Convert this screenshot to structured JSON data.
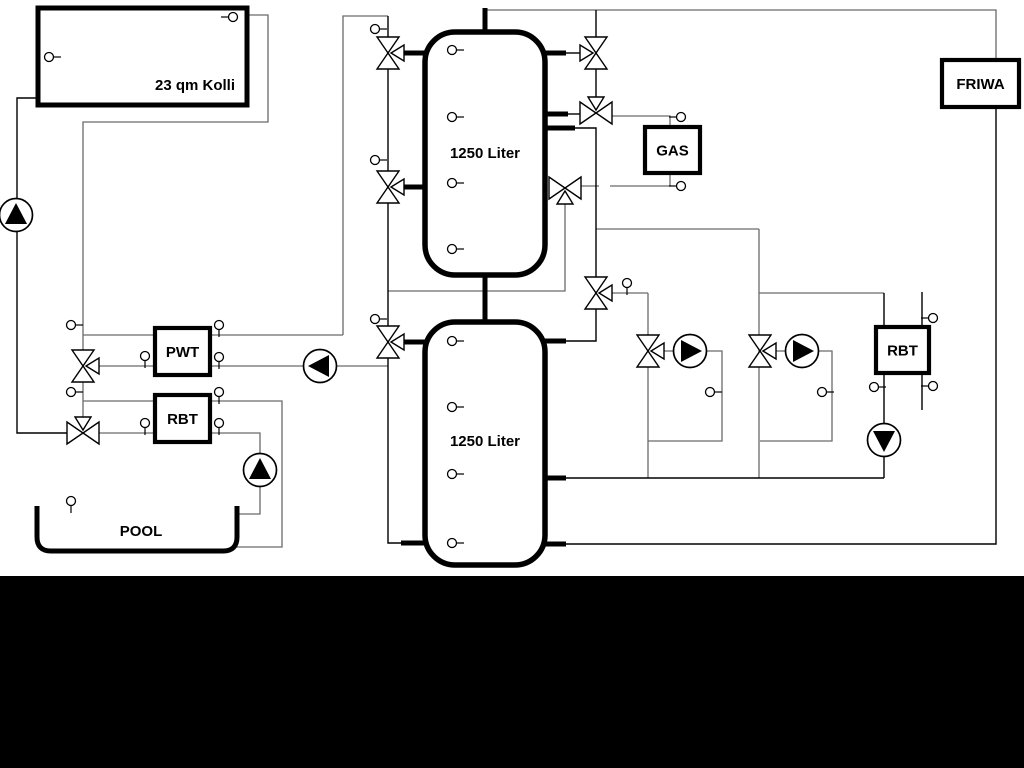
{
  "diagram": {
    "title": "Hydraulic schematic: solar collector, buffer tanks, gas boiler, pool",
    "background": "#ffffff",
    "bottom_bar": {
      "top": 576,
      "color": "#000000"
    },
    "colors": {
      "black": "#000000",
      "gray": "#6a6a6a",
      "fill": "#ffffff"
    },
    "labels": {
      "collector": "23 qm Kolli",
      "tank_top": "1250 Liter",
      "tank_bottom": "1250 Liter",
      "pwt": "PWT",
      "rbt_left": "RBT",
      "rbt_right": "RBT",
      "gas": "GAS",
      "friwa": "FRIWA",
      "pool": "POOL"
    },
    "collector": {
      "x": 38,
      "y": 8,
      "w": 209,
      "h": 97,
      "label": "collector",
      "label_x": 195,
      "label_y": 90
    },
    "tanks": [
      {
        "x": 425,
        "y": 32,
        "w": 120,
        "h": 243,
        "r": 30,
        "label": "tank_top",
        "name": "buffer-tank-1",
        "label_y": 158
      },
      {
        "x": 425,
        "y": 322,
        "w": 120,
        "h": 243,
        "r": 30,
        "label": "tank_bottom",
        "name": "buffer-tank-2",
        "label_y": 446
      }
    ],
    "boxes": [
      {
        "x": 155,
        "y": 328,
        "w": 55,
        "h": 47,
        "label": "pwt",
        "name": "pwt-heat-exchanger"
      },
      {
        "x": 155,
        "y": 395,
        "w": 55,
        "h": 47,
        "label": "rbt_left",
        "name": "rbt-left-heat-exchanger"
      },
      {
        "x": 645,
        "y": 127,
        "w": 55,
        "h": 46,
        "label": "gas",
        "name": "gas-boiler"
      },
      {
        "x": 942,
        "y": 60,
        "w": 77,
        "h": 47,
        "label": "friwa",
        "name": "friwa-station"
      },
      {
        "x": 876,
        "y": 327,
        "w": 53,
        "h": 46,
        "label": "rbt_right",
        "name": "rbt-right-heat-exchanger"
      }
    ],
    "pool": {
      "x1": 37,
      "x2": 237,
      "top": 506,
      "bottom": 551,
      "r": 14,
      "label": "pool",
      "label_x": 141,
      "label_y": 536
    },
    "lines": [
      {
        "c": "gray",
        "pts": [
          [
            247,
            15
          ],
          [
            268,
            15
          ],
          [
            268,
            122
          ],
          [
            83,
            122
          ],
          [
            83,
            419
          ]
        ]
      },
      {
        "c": "gray",
        "pts": [
          [
            83,
            335
          ],
          [
            155,
            335
          ]
        ]
      },
      {
        "c": "gray",
        "pts": [
          [
            210,
            335
          ],
          [
            343,
            335
          ]
        ]
      },
      {
        "c": "gray",
        "pts": [
          [
            343,
            335
          ],
          [
            343,
            16
          ],
          [
            388,
            16
          ]
        ]
      },
      {
        "c": "gray",
        "pts": [
          [
            97,
            366
          ],
          [
            155,
            366
          ]
        ]
      },
      {
        "c": "gray",
        "pts": [
          [
            210,
            366
          ],
          [
            388,
            366
          ]
        ]
      },
      {
        "c": "gray",
        "pts": [
          [
            83,
            401
          ],
          [
            155,
            401
          ]
        ]
      },
      {
        "c": "gray",
        "pts": [
          [
            210,
            401
          ],
          [
            282,
            401
          ],
          [
            282,
            547
          ],
          [
            237,
            547
          ]
        ]
      },
      {
        "c": "gray",
        "pts": [
          [
            99,
            433
          ],
          [
            155,
            433
          ]
        ]
      },
      {
        "c": "gray",
        "pts": [
          [
            210,
            433
          ],
          [
            260,
            433
          ],
          [
            260,
            514
          ],
          [
            239,
            514
          ]
        ]
      },
      {
        "c": "gray",
        "pts": [
          [
            485,
            10
          ],
          [
            996,
            10
          ],
          [
            996,
            60
          ]
        ]
      },
      {
        "c": "gray",
        "pts": [
          [
            596,
            229
          ],
          [
            759,
            229
          ]
        ]
      },
      {
        "c": "gray",
        "pts": [
          [
            759,
            229
          ],
          [
            759,
            478
          ]
        ]
      },
      {
        "c": "gray",
        "pts": [
          [
            759,
            293
          ],
          [
            884,
            293
          ]
        ]
      },
      {
        "c": "gray",
        "pts": [
          [
            611,
            293
          ],
          [
            648,
            293
          ]
        ]
      },
      {
        "c": "gray",
        "pts": [
          [
            648,
            293
          ],
          [
            648,
            478
          ]
        ]
      },
      {
        "c": "gray",
        "pts": [
          [
            664,
            351
          ],
          [
            675,
            351
          ]
        ]
      },
      {
        "c": "gray",
        "pts": [
          [
            706,
            351
          ],
          [
            722,
            351
          ],
          [
            722,
            441
          ],
          [
            648,
            441
          ]
        ]
      },
      {
        "c": "gray",
        "pts": [
          [
            776,
            351
          ],
          [
            787,
            351
          ]
        ]
      },
      {
        "c": "gray",
        "pts": [
          [
            818,
            351
          ],
          [
            832,
            351
          ],
          [
            832,
            441
          ],
          [
            760,
            441
          ]
        ]
      },
      {
        "c": "gray",
        "pts": [
          [
            612,
            116
          ],
          [
            670,
            116
          ],
          [
            670,
            128
          ]
        ]
      },
      {
        "c": "gray",
        "pts": [
          [
            670,
            173
          ],
          [
            670,
            186
          ],
          [
            610,
            186
          ]
        ]
      },
      {
        "c": "gray",
        "pts": [
          [
            580,
            186
          ],
          [
            599,
            186
          ]
        ]
      },
      {
        "c": "gray",
        "pts": [
          [
            565,
            202
          ],
          [
            565,
            291
          ],
          [
            388,
            291
          ]
        ]
      },
      {
        "c": "black",
        "pts": [
          [
            38,
            98
          ],
          [
            17,
            98
          ],
          [
            17,
            433
          ],
          [
            70,
            433
          ]
        ]
      },
      {
        "c": "black",
        "pts": [
          [
            388,
            16
          ],
          [
            388,
            543
          ],
          [
            402,
            543
          ]
        ]
      },
      {
        "c": "black",
        "pts": [
          [
            566,
            53
          ],
          [
            581,
            53
          ]
        ]
      },
      {
        "c": "black",
        "pts": [
          [
            596,
            10
          ],
          [
            596,
            100
          ]
        ]
      },
      {
        "c": "black",
        "pts": [
          [
            566,
            114
          ],
          [
            582,
            114
          ]
        ]
      },
      {
        "c": "black",
        "pts": [
          [
            575,
            128
          ],
          [
            596,
            128
          ],
          [
            596,
            341
          ],
          [
            566,
            341
          ]
        ]
      },
      {
        "c": "black",
        "pts": [
          [
            566,
            478
          ],
          [
            884,
            478
          ]
        ]
      },
      {
        "c": "black",
        "pts": [
          [
            566,
            544
          ],
          [
            996,
            544
          ],
          [
            996,
            107
          ]
        ]
      },
      {
        "c": "black",
        "pts": [
          [
            884,
            293
          ],
          [
            884,
            478
          ]
        ]
      },
      {
        "c": "black",
        "pts": [
          [
            922,
            292
          ],
          [
            922,
            410
          ]
        ]
      }
    ],
    "stubs": [
      [
        485,
        8,
        485,
        32
      ],
      [
        485,
        275,
        485,
        322
      ],
      [
        401,
        53,
        426,
        53
      ],
      [
        401,
        187,
        426,
        187
      ],
      [
        544,
        53,
        566,
        53
      ],
      [
        544,
        114,
        568,
        114
      ],
      [
        544,
        128,
        575,
        128
      ],
      [
        401,
        342,
        426,
        342
      ],
      [
        401,
        543,
        426,
        543
      ],
      [
        544,
        341,
        566,
        341
      ],
      [
        544,
        478,
        566,
        478
      ],
      [
        544,
        544,
        566,
        544
      ]
    ],
    "valves": [
      {
        "x": 388,
        "y": 53,
        "o": "v",
        "a": "r",
        "name": "three-way-valve-tank1-top-left"
      },
      {
        "x": 596,
        "y": 53,
        "o": "v",
        "a": "l",
        "name": "three-way-valve-tank1-top-right"
      },
      {
        "x": 596,
        "y": 113,
        "o": "h",
        "a": "u",
        "name": "three-way-valve-gas-flow"
      },
      {
        "x": 565,
        "y": 188,
        "o": "h",
        "a": "d",
        "name": "three-way-valve-gas-return"
      },
      {
        "x": 388,
        "y": 187,
        "o": "v",
        "a": "r",
        "name": "three-way-valve-tank1-mid-left"
      },
      {
        "x": 83,
        "y": 366,
        "o": "v",
        "a": "r",
        "name": "three-way-valve-solar-pwt"
      },
      {
        "x": 83,
        "y": 433,
        "o": "h",
        "a": "u",
        "name": "three-way-valve-solar-rbt"
      },
      {
        "x": 388,
        "y": 342,
        "o": "v",
        "a": "r",
        "name": "three-way-valve-tank2-left"
      },
      {
        "x": 596,
        "y": 293,
        "o": "v",
        "a": "r",
        "name": "three-way-valve-tank2-right"
      },
      {
        "x": 648,
        "y": 351,
        "o": "v",
        "a": "r",
        "name": "three-way-valve-heating-circuit-1"
      },
      {
        "x": 760,
        "y": 351,
        "o": "v",
        "a": "r",
        "name": "three-way-valve-heating-circuit-2"
      }
    ],
    "pumps": [
      {
        "x": 16,
        "y": 215,
        "d": "u",
        "name": "pump-solar"
      },
      {
        "x": 320,
        "y": 366,
        "d": "l",
        "name": "pump-pwt-circuit"
      },
      {
        "x": 260,
        "y": 470,
        "d": "u",
        "name": "pump-pool-circuit"
      },
      {
        "x": 690,
        "y": 351,
        "d": "r",
        "name": "pump-heating-circuit-1"
      },
      {
        "x": 802,
        "y": 351,
        "d": "r",
        "name": "pump-heating-circuit-2"
      },
      {
        "x": 884,
        "y": 440,
        "d": "d",
        "name": "pump-rbt-right"
      }
    ],
    "sensors": [
      {
        "x": 49,
        "y": 57,
        "s": "r"
      },
      {
        "x": 233,
        "y": 17,
        "s": "l"
      },
      {
        "x": 71,
        "y": 325,
        "s": "r"
      },
      {
        "x": 71,
        "y": 392,
        "s": "r"
      },
      {
        "x": 145,
        "y": 356,
        "s": "d"
      },
      {
        "x": 219,
        "y": 325,
        "s": "d"
      },
      {
        "x": 219,
        "y": 357,
        "s": "d"
      },
      {
        "x": 145,
        "y": 423,
        "s": "d"
      },
      {
        "x": 219,
        "y": 392,
        "s": "d"
      },
      {
        "x": 219,
        "y": 423,
        "s": "d"
      },
      {
        "x": 71,
        "y": 501,
        "s": "d"
      },
      {
        "x": 375,
        "y": 29,
        "s": "r"
      },
      {
        "x": 375,
        "y": 160,
        "s": "r"
      },
      {
        "x": 375,
        "y": 319,
        "s": "r"
      },
      {
        "x": 452,
        "y": 50,
        "s": "r"
      },
      {
        "x": 452,
        "y": 117,
        "s": "r"
      },
      {
        "x": 452,
        "y": 183,
        "s": "r"
      },
      {
        "x": 452,
        "y": 249,
        "s": "r"
      },
      {
        "x": 452,
        "y": 341,
        "s": "r"
      },
      {
        "x": 452,
        "y": 407,
        "s": "r"
      },
      {
        "x": 452,
        "y": 474,
        "s": "r"
      },
      {
        "x": 452,
        "y": 543,
        "s": "r"
      },
      {
        "x": 627,
        "y": 283,
        "s": "d"
      },
      {
        "x": 681,
        "y": 117,
        "s": "l"
      },
      {
        "x": 681,
        "y": 186,
        "s": "l"
      },
      {
        "x": 710,
        "y": 392,
        "s": "r"
      },
      {
        "x": 822,
        "y": 392,
        "s": "r"
      },
      {
        "x": 874,
        "y": 387,
        "s": "r"
      },
      {
        "x": 933,
        "y": 318,
        "s": "l"
      },
      {
        "x": 933,
        "y": 386,
        "s": "l"
      }
    ]
  }
}
